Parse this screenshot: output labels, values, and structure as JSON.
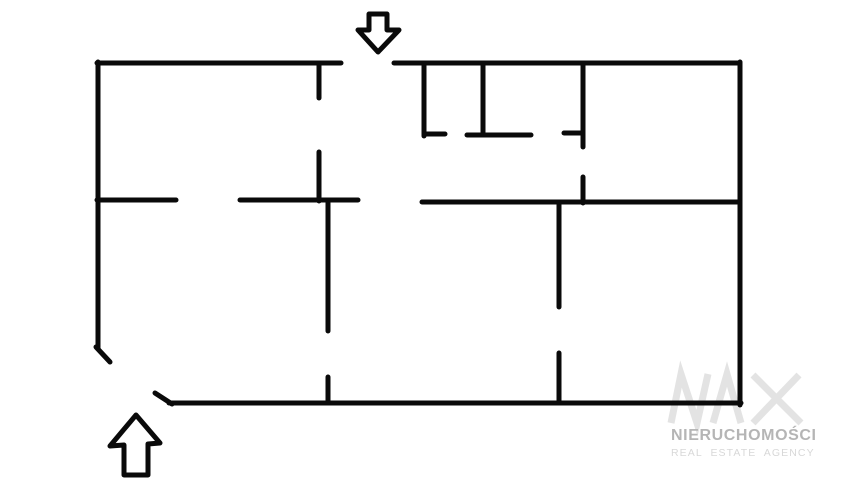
{
  "floor_plan": {
    "background_color": "#ffffff",
    "wall_color": "#0a0a0a",
    "wall_thickness": 5,
    "walls": [
      {
        "name": "top-wall-left",
        "x1": 97,
        "y1": 63,
        "x2": 341,
        "y2": 63
      },
      {
        "name": "top-wall-right",
        "x1": 394,
        "y1": 63,
        "x2": 740,
        "y2": 63
      },
      {
        "name": "left-wall",
        "x1": 98,
        "y1": 62,
        "x2": 98,
        "y2": 348
      },
      {
        "name": "left-entrance-jamb",
        "x1": 96,
        "y1": 347,
        "x2": 110,
        "y2": 362
      },
      {
        "name": "right-wall",
        "x1": 740,
        "y1": 62,
        "x2": 740,
        "y2": 405
      },
      {
        "name": "bottom-wall",
        "x1": 169,
        "y1": 403,
        "x2": 741,
        "y2": 403
      },
      {
        "name": "bottom-entrance-jamb",
        "x1": 155,
        "y1": 393,
        "x2": 172,
        "y2": 404
      },
      {
        "name": "upper-partition-stub",
        "x1": 319,
        "y1": 63,
        "x2": 319,
        "y2": 98
      },
      {
        "name": "upper-partition",
        "x1": 319,
        "y1": 152,
        "x2": 319,
        "y2": 201
      },
      {
        "name": "left-corridor-wall-a",
        "x1": 97,
        "y1": 200,
        "x2": 176,
        "y2": 200
      },
      {
        "name": "left-corridor-wall-b",
        "x1": 240,
        "y1": 200,
        "x2": 358,
        "y2": 200
      },
      {
        "name": "center-partition",
        "x1": 328,
        "y1": 202,
        "x2": 328,
        "y2": 331
      },
      {
        "name": "center-partition-stub",
        "x1": 328,
        "y1": 377,
        "x2": 328,
        "y2": 403
      },
      {
        "name": "right-corridor-wall",
        "x1": 422,
        "y1": 202,
        "x2": 740,
        "y2": 202
      },
      {
        "name": "lower-right-partition",
        "x1": 559,
        "y1": 202,
        "x2": 559,
        "y2": 307
      },
      {
        "name": "lower-right-partition-stub",
        "x1": 559,
        "y1": 353,
        "x2": 559,
        "y2": 403
      },
      {
        "name": "closet-wall-1",
        "x1": 424,
        "y1": 63,
        "x2": 424,
        "y2": 136
      },
      {
        "name": "closet-wall-1-return",
        "x1": 424,
        "y1": 134,
        "x2": 445,
        "y2": 134
      },
      {
        "name": "closet-wall-2",
        "x1": 483,
        "y1": 63,
        "x2": 483,
        "y2": 135
      },
      {
        "name": "closet-bottom-wall",
        "x1": 467,
        "y1": 135,
        "x2": 531,
        "y2": 135
      },
      {
        "name": "closet-wall-3",
        "x1": 583,
        "y1": 63,
        "x2": 583,
        "y2": 147
      },
      {
        "name": "closet-wall-3-return",
        "x1": 564,
        "y1": 133,
        "x2": 583,
        "y2": 133
      },
      {
        "name": "upper-right-partition-stub",
        "x1": 583,
        "y1": 177,
        "x2": 583,
        "y2": 203
      }
    ],
    "entrances": [
      {
        "name": "main-entrance-arrow",
        "direction": "down",
        "points": [
          [
            369,
            14
          ],
          [
            387,
            14
          ],
          [
            387,
            30
          ],
          [
            399,
            30
          ],
          [
            378,
            52
          ],
          [
            358,
            30
          ],
          [
            369,
            30
          ]
        ]
      },
      {
        "name": "secondary-entrance-arrow",
        "direction": "up",
        "points": [
          [
            136,
            415
          ],
          [
            110,
            446
          ],
          [
            124,
            445
          ],
          [
            124,
            475
          ],
          [
            148,
            475
          ],
          [
            148,
            444
          ],
          [
            160,
            443
          ]
        ]
      }
    ]
  },
  "watermark": {
    "logo_text": "NAX",
    "logo_color": "#e3e3e3",
    "logo_stroke_width": 7,
    "logo_strokes": [
      [
        [
          671,
          423
        ],
        [
          681,
          374
        ],
        [
          697,
          423
        ],
        [
          708,
          374
        ]
      ],
      [
        [
          713,
          423
        ],
        [
          727,
          374
        ],
        [
          741,
          423
        ]
      ],
      [
        [
          753,
          375
        ],
        [
          801,
          423
        ]
      ],
      [
        [
          799,
          375
        ],
        [
          753,
          423
        ]
      ]
    ],
    "line1": "NIERUCHOMOŚCI",
    "line1_color": "#b5b5b5",
    "line2": "REAL ESTATE AGENCY",
    "line2_color": "#d8d8d8"
  }
}
